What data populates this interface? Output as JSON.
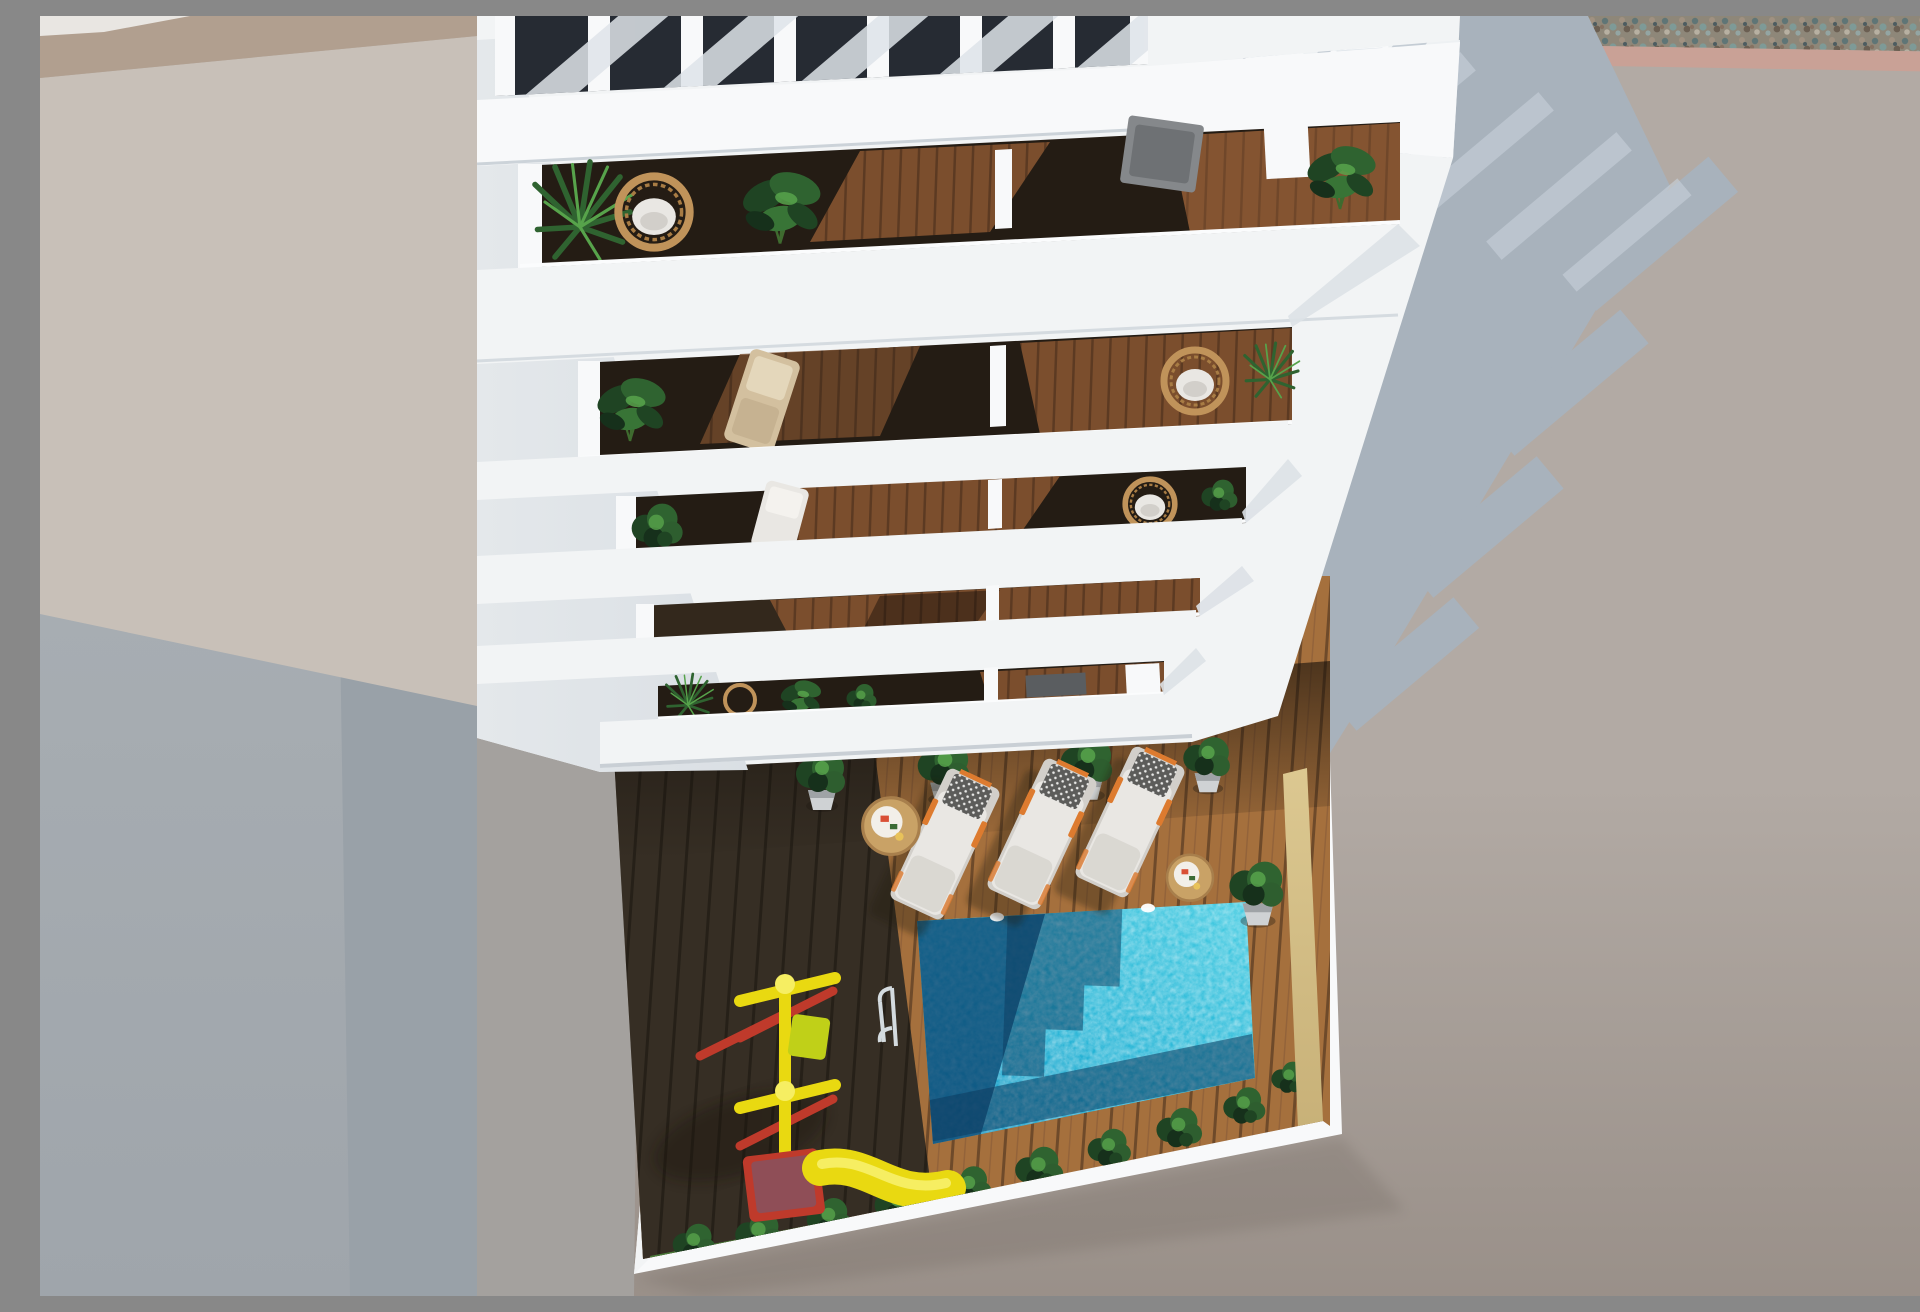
{
  "scene": {
    "type": "3d-architectural-render",
    "view": "top-down aerial",
    "description": "Aerial top-down 3D rendering of a white multi-storey apartment building with five stacked balcony rows holding plants, rattan chairs and loungers, a rooftop pergola, and a communal courtyard below with a wooden deck, turquoise swimming pool, three sun loungers, side tables, potted plants, dark green hedges and a children's playground with a yellow slide.",
    "objects": {
      "balcony_rows": 5,
      "pergola_slats": 8,
      "sun_loungers": 3,
      "side_tables": 2,
      "hanging_wicker_chairs": 4,
      "potted_plants": 5,
      "swimming_pools": 1,
      "pool_ladders": 1,
      "slides": 1,
      "play_structures": 1
    }
  },
  "palette": {
    "white": "#f2f4f5",
    "white-bright": "#f8f9fa",
    "white-face": "#e4e8eb",
    "white-face2": "#dadfe4",
    "interior-dark": "#241c14",
    "interior-dark2": "#33281c",
    "wood-balc": "#7b4e2d",
    "wood-balc-lit": "#96603a",
    "deck-lit": "#a5703d",
    "deck-lit-line": "#6e4a2a",
    "deck-shadow": "#473d30",
    "deck-shadow-line": "#2e271e",
    "pool-bright": "#25b4d6",
    "pool-bright2": "#45cce2",
    "pool-mid": "#1792c0",
    "pool-dark": "#0d4a74",
    "pool-deep": "#0d3a5e",
    "pale-wall": "#dcc891",
    "pale-wall2": "#c8b178",
    "grass": "#4a7c3a",
    "bush-dark": "#16301b",
    "bush-mid": "#1f4423",
    "bush-light": "#2e5e2f",
    "plant-green": "#2f6330",
    "plant-light": "#57a34b",
    "wicker": "#c0935a",
    "cushion": "#e9e7e3",
    "cushion-shade": "#d2cfca",
    "pillow-grid": "#5c5c5a",
    "lounger-orange": "#dd7b2f",
    "tan-chair": "#d3c09f",
    "gray-chair": "#85888b",
    "slide-yellow": "#e9d911",
    "slide-yellow2": "#f6ee62",
    "play-red": "#bf3a2b",
    "play-maroon": "#8f4e57",
    "swing-green": "#c0d018",
    "ground-left-beige": "#c8c0b8",
    "ground-left-tan": "#b19f8f",
    "wall-cool": "#a7adb2",
    "wall-cool2": "#99a1a8",
    "wall-cool3": "#9fa5ab",
    "ground-right": "#b2aaa4",
    "ground-shadow": "#a8b2bc",
    "ground-shadow-light": "#c6cfd8",
    "ground-pink": "#c9a196",
    "gravel-base": "#8e8779",
    "table-wood": "#c9a266"
  }
}
